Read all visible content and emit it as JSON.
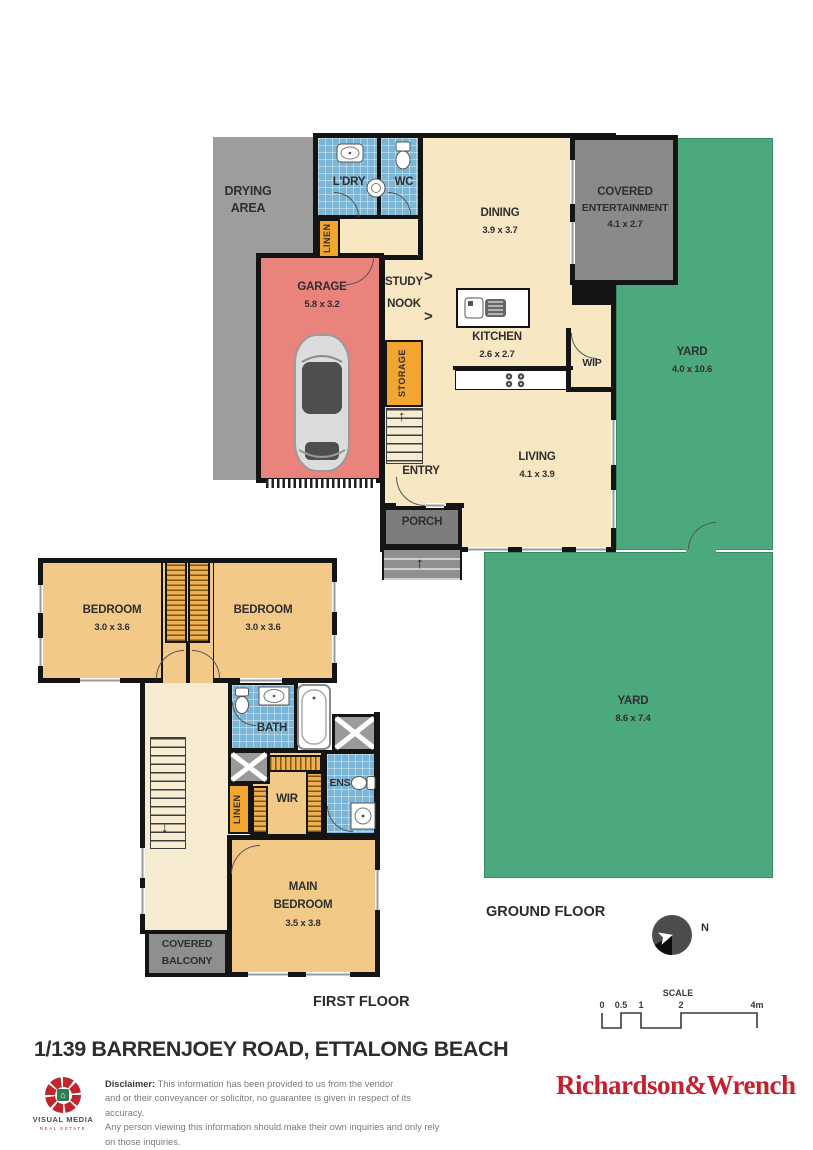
{
  "palette": {
    "wall_black": "#141414",
    "floor_cream": "#f8e7c3",
    "bedroom_tan": "#f2c987",
    "garage_red": "#e9837b",
    "tile_blue": "#7cb6d6",
    "cabinet_orange": "#f2a52f",
    "yard_green": "#4ca87d",
    "outdoor_grey": "#9d9d9d",
    "entertainment_grey": "#8a8a8a",
    "brand_red": "#c5202e"
  },
  "ground_floor": {
    "floor_label": "GROUND FLOOR",
    "rooms": {
      "drying_area": {
        "line1": "DRYING",
        "line2": "AREA"
      },
      "ldry": {
        "label": "L'DRY"
      },
      "wc": {
        "label": "WC"
      },
      "dining": {
        "label": "DINING",
        "dims": "3.9 x 3.7"
      },
      "entertainment": {
        "line1": "COVERED",
        "line2": "ENTERTAINMENT",
        "dims": "4.1 x 2.7"
      },
      "yard_side": {
        "label": "YARD",
        "dims": "4.0 x 10.6"
      },
      "linen": {
        "label": "LINEN"
      },
      "garage": {
        "label": "GARAGE",
        "dims": "5.8 x 3.2"
      },
      "study_nook": {
        "line1": "STUDY",
        "line2": "NOOK"
      },
      "storage": {
        "label": "STORAGE"
      },
      "kitchen": {
        "label": "KITCHEN",
        "dims": "2.6 x 2.7"
      },
      "wip": {
        "label": "WIP"
      },
      "entry": {
        "label": "ENTRY"
      },
      "living": {
        "label": "LIVING",
        "dims": "4.1 x 3.9"
      },
      "porch": {
        "label": "PORCH"
      },
      "yard_back": {
        "label": "YARD",
        "dims": "8.6 x 7.4"
      }
    }
  },
  "first_floor": {
    "floor_label": "FIRST FLOOR",
    "rooms": {
      "bedroom1": {
        "label": "BEDROOM",
        "dims": "3.0 x 3.6"
      },
      "bedroom2": {
        "label": "BEDROOM",
        "dims": "3.0 x 3.6"
      },
      "bath": {
        "label": "BATH"
      },
      "wir": {
        "label": "WIR"
      },
      "ens": {
        "label": "ENS"
      },
      "linen": {
        "label": "LINEN"
      },
      "main_bedroom": {
        "line1": "MAIN",
        "line2": "BEDROOM",
        "dims": "3.5 x 3.8"
      },
      "covered_balcony": {
        "line1": "COVERED",
        "line2": "BALCONY"
      }
    }
  },
  "compass": {
    "north_label": "N"
  },
  "scale": {
    "label": "SCALE",
    "ticks": [
      "0",
      "0.5",
      "1",
      "2",
      "4m"
    ]
  },
  "footer": {
    "address": "1/139 BARRENJOEY ROAD, ETTALONG BEACH",
    "logo_name": "VISUAL MEDIA",
    "logo_tagline": "REAL ESTATE",
    "disclaimer_bold": "Disclaimer:",
    "disclaimer_lines": [
      "This information has been provided to us from the vendor",
      "and or their conveyancer or solicitor, no guarantee is given in respect of its accuracy.",
      "Any person viewing this information should make their own inquiries and only rely on those inquiries."
    ],
    "brand": "Richardson&Wrench"
  }
}
